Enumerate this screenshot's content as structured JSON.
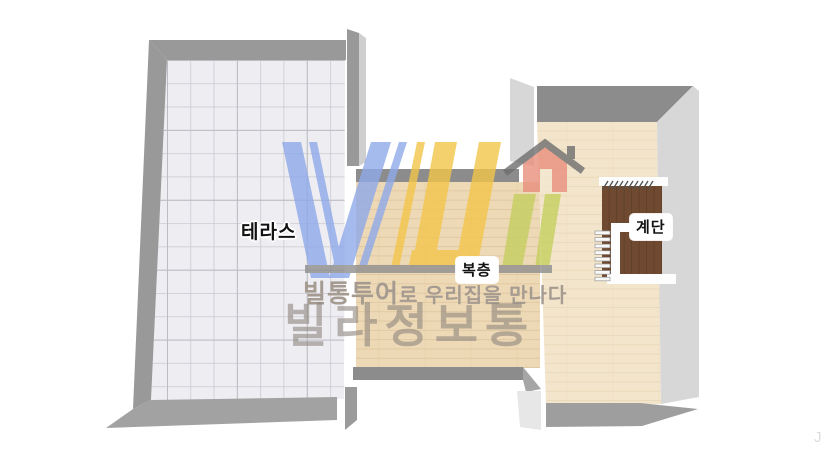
{
  "canvas": {
    "width": 840,
    "height": 472
  },
  "rooms": {
    "terrace": {
      "label": "테라스"
    },
    "loft": {
      "label": "복층"
    },
    "stairs": {
      "label": "계단"
    }
  },
  "watermark": {
    "tagline_bold": "빌통투어",
    "tagline_rest": "로 우리집을 만나다",
    "brand": "빌라정보통",
    "corner_artifact": "J"
  },
  "colors": {
    "wall_gray": "#999999",
    "wall_dark": "#8c8c8c",
    "wall_bottom": "#a2a2a2",
    "wall_light": "#d7d7d7",
    "tile_floor": "#eeedf1",
    "tile_line": "#c9c9d0",
    "wood_floor": "#eed9b6",
    "wood_line": "#dfc69f",
    "wood_floor_light": "#f3e5cb",
    "wood_line_light": "#e9d8ba",
    "stair_brown": "#6f4a31",
    "stair_line": "#5c3b26",
    "logo_blue": "#8fa9e9",
    "logo_yellow": "#f3c64b",
    "logo_green": "#c6cf5f",
    "logo_red": "#e98f7d",
    "logo_roof": "#6f6f6f",
    "logo_bar": "#8f8f8f"
  }
}
